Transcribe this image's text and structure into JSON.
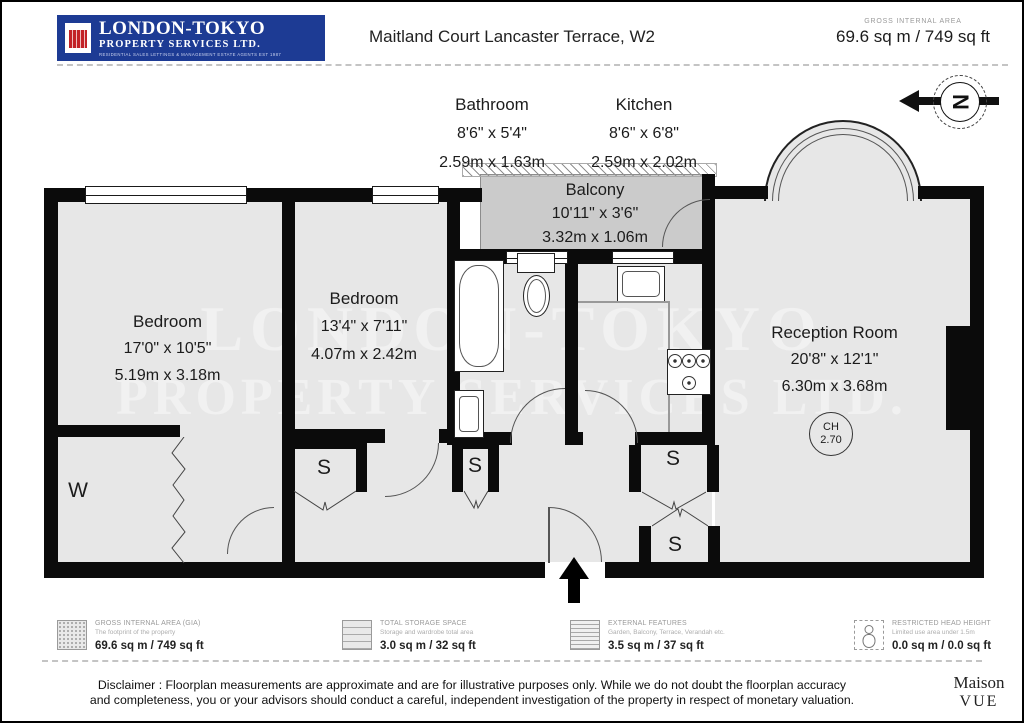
{
  "header": {
    "logo": {
      "line1": "LONDON-TOKYO",
      "line2": "PROPERTY SERVICES LTD.",
      "tagline": "RESIDENTIAL SALES LETTINGS & MANAGEMENT ESTATE AGENTS EST 1987"
    },
    "title": "Maitland Court Lancaster Terrace, W2",
    "gia_label": "GROSS INTERNAL AREA",
    "gia_value": "69.6 sq m / 749 sq ft"
  },
  "compass": {
    "letter": "N"
  },
  "watermark": {
    "line1": "LONDON-TOKYO",
    "line2": "PROPERTY SERVICES LTD."
  },
  "rooms": {
    "bathroom": {
      "name": "Bathroom",
      "imperial": "8'6\" x 5'4\"",
      "metric": "2.59m x 1.63m"
    },
    "kitchen": {
      "name": "Kitchen",
      "imperial": "8'6\" x 6'8\"",
      "metric": "2.59m x 2.02m"
    },
    "balcony": {
      "name": "Balcony",
      "imperial": "10'11\" x 3'6\"",
      "metric": "3.32m x 1.06m"
    },
    "bedroom1": {
      "name": "Bedroom",
      "imperial": "17'0\" x 10'5\"",
      "metric": "5.19m x 3.18m"
    },
    "bedroom2": {
      "name": "Bedroom",
      "imperial": "13'4\" x 7'11\"",
      "metric": "4.07m x 2.42m"
    },
    "reception": {
      "name": "Reception Room",
      "imperial": "20'8\" x 12'1\"",
      "metric": "6.30m x 3.68m"
    }
  },
  "ceiling_height": {
    "label": "CH",
    "value": "2.70"
  },
  "markers": {
    "wardrobe": "W",
    "storage": "S"
  },
  "legend": {
    "items": [
      {
        "title": "GROSS INTERNAL AREA (GIA)",
        "subtitle": "The footprint of the property",
        "value": "69.6 sq m / 749 sq ft"
      },
      {
        "title": "TOTAL STORAGE SPACE",
        "subtitle": "Storage and wardrobe total area",
        "value": "3.0 sq m / 32 sq ft"
      },
      {
        "title": "EXTERNAL FEATURES",
        "subtitle": "Garden, Balcony, Terrace, Verandah etc.",
        "value": "3.5 sq m / 37 sq ft"
      },
      {
        "title": "RESTRICTED HEAD HEIGHT",
        "subtitle": "Limited use area under 1.5m",
        "value": "0.0 sq m / 0.0 sq ft"
      }
    ]
  },
  "disclaimer": {
    "line1": "Disclaimer : Floorplan measurements are approximate and are for illustrative purposes only. While we do not doubt the floorplan accuracy",
    "line2": "and completeness, you or your advisors should conduct a careful, independent investigation of the property in respect of monetary valuation."
  },
  "brand": {
    "line1": "Maison",
    "line2": "VUE"
  },
  "colors": {
    "logo_blue": "#1d3b94",
    "crest_red": "#c22126",
    "wall": "#0b0b0b",
    "room_fill": "#e7e7e7",
    "balcony_fill": "#cbcbcb",
    "watermark": "#f1f1f1"
  }
}
